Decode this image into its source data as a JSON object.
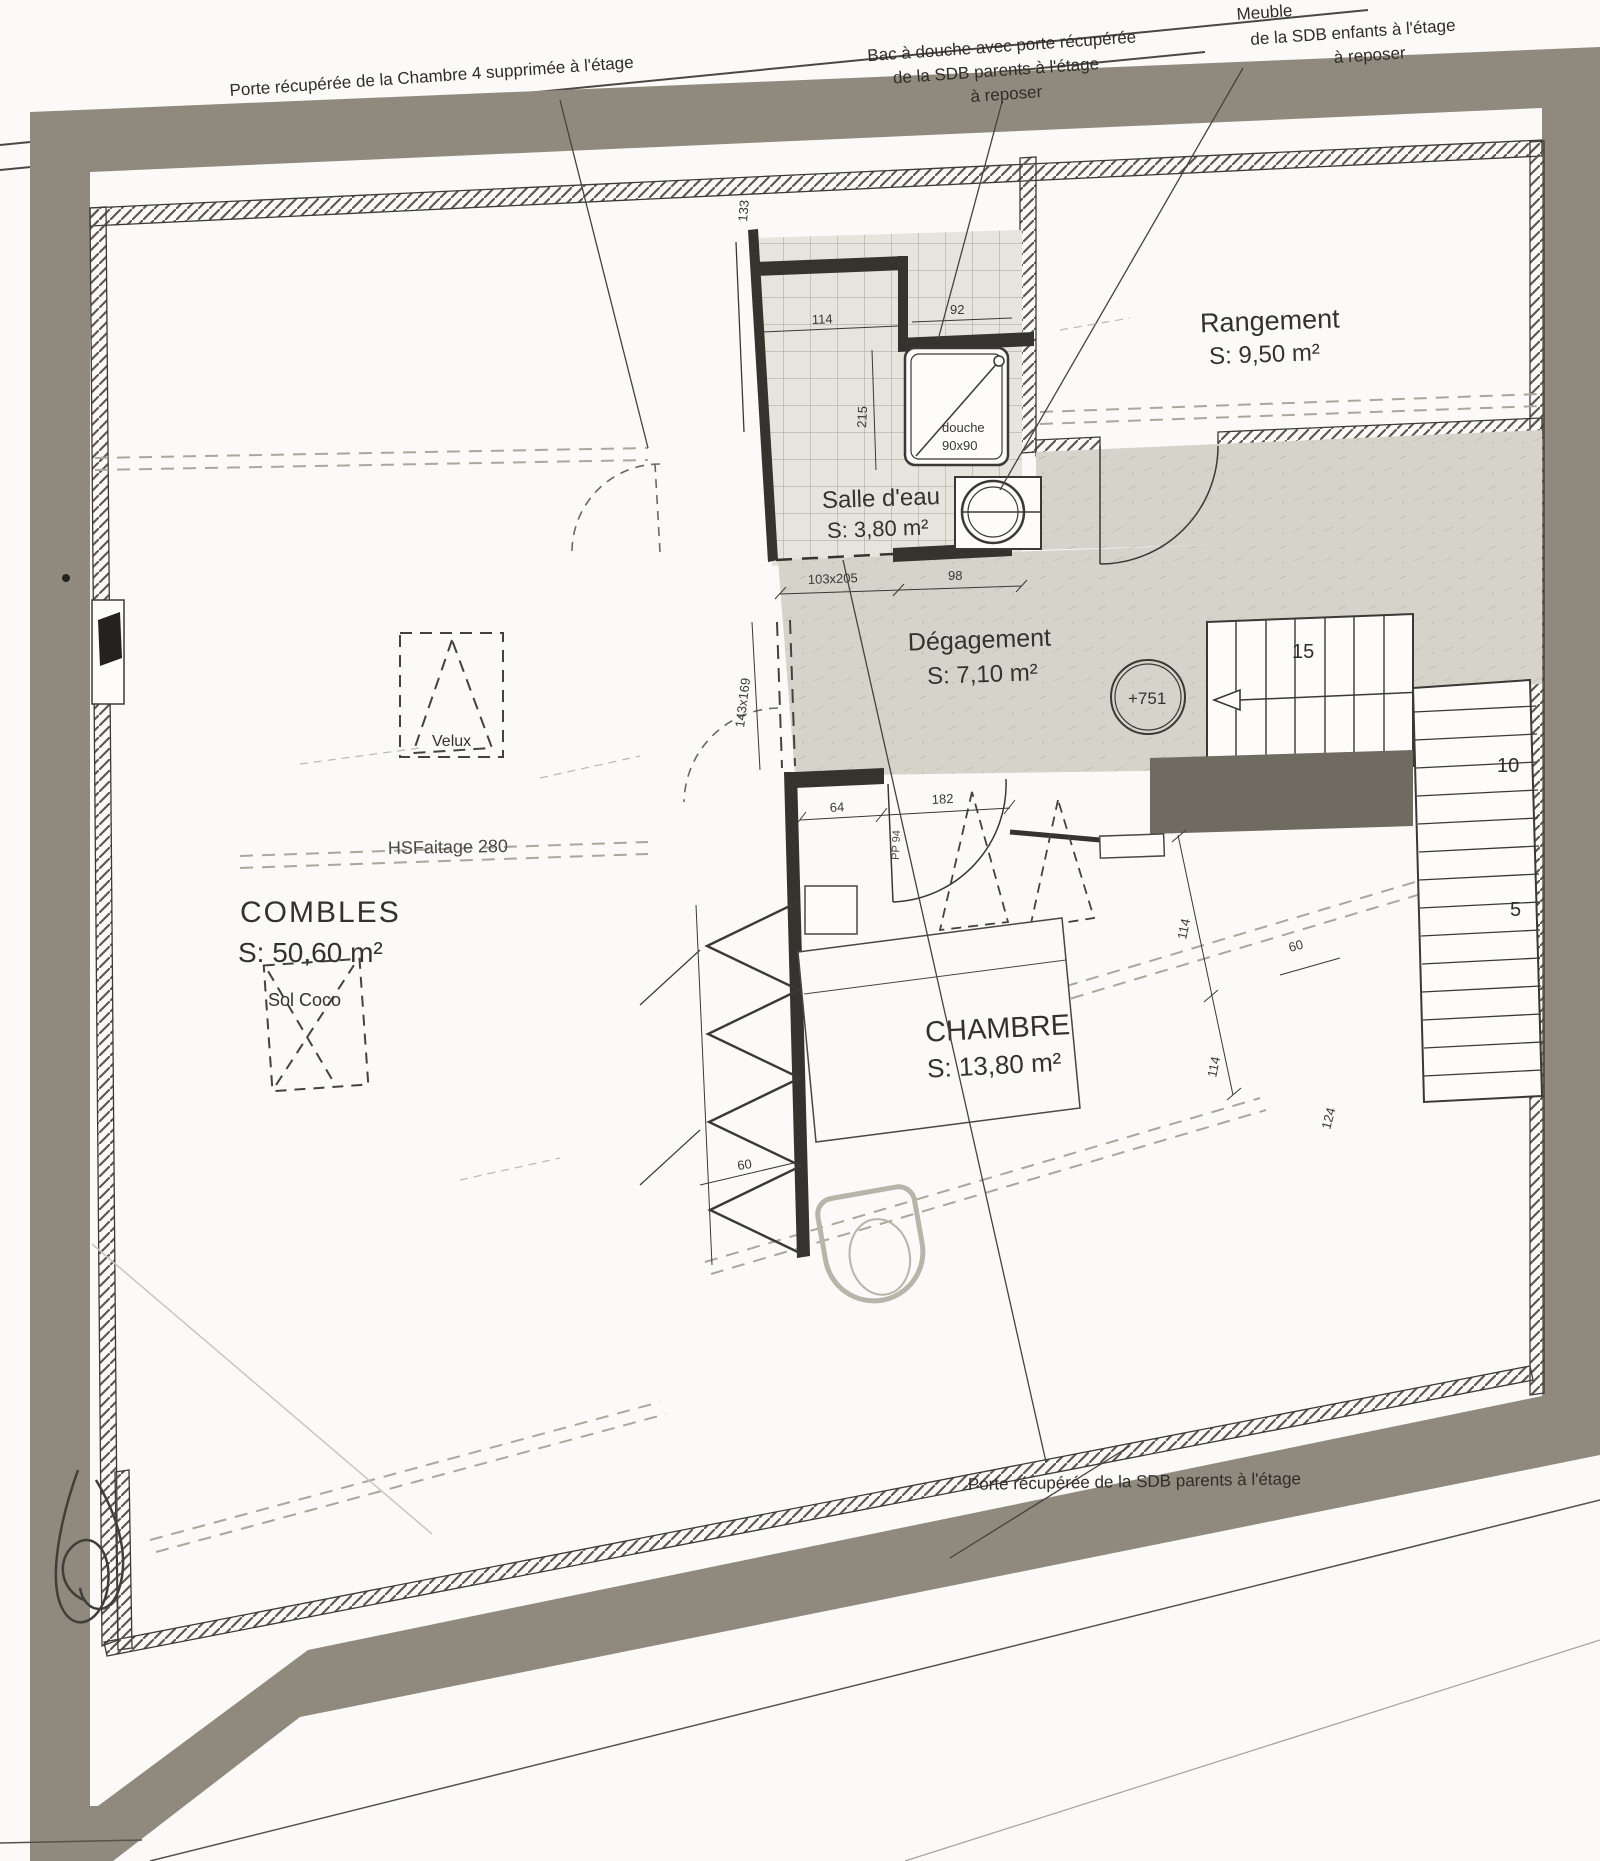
{
  "annotations": {
    "top_left": {
      "text": "Porte récupérée de la Chambre 4 supprimée à l'étage"
    },
    "top_center": {
      "line1": "Bac à douche avec porte récupérée",
      "line2": "de la SDB parents à l'étage",
      "line3": "à reposer"
    },
    "top_right": {
      "line1": "Meuble",
      "line2": "de la SDB enfants à l'étage",
      "line3": "à reposer"
    },
    "bottom": {
      "text": "Porte récupérée de la SDB parents à l'étage"
    }
  },
  "rooms": {
    "combles": {
      "name": "COMBLES",
      "area": "S: 50,60 m²",
      "floor": "Sol Coco"
    },
    "salle_eau": {
      "name": "Salle d'eau",
      "area": "S: 3,80 m²"
    },
    "degagement": {
      "name": "Dégagement",
      "area": "S: 7,10 m²"
    },
    "rangement": {
      "name": "Rangement",
      "area": "S: 9,50 m²"
    },
    "chambre": {
      "name": "CHAMBRE",
      "area": "S: 13,80 m²"
    }
  },
  "labels": {
    "velux": "Velux",
    "ridge": "HSFaitage 280",
    "shower_line1": "douche",
    "shower_line2": "90x90",
    "level": "+751"
  },
  "stairs": {
    "count_top": "15",
    "count_mid": "10",
    "count_low": "5"
  },
  "dimensions": {
    "top_wall": "133",
    "tile_width": "114",
    "shower_width": "92",
    "tile_height": "215",
    "se_door": "103x205",
    "se_right": "98",
    "comb_door": "143x169",
    "ch_seg1": "64",
    "ch_seg2": "182",
    "ch_door": "PP 94",
    "east_seg1": "114",
    "east_seg2": "114",
    "closet_depth": "60",
    "east_seg3": "124",
    "wardrobe_depth": "60"
  },
  "colors": {
    "wall_band": "#8f8a7d",
    "dark_wall": "#35332e",
    "dark_block": "#6f6b60",
    "floor_gray": "#d6d3ca",
    "paper": "#fbfaf8"
  }
}
